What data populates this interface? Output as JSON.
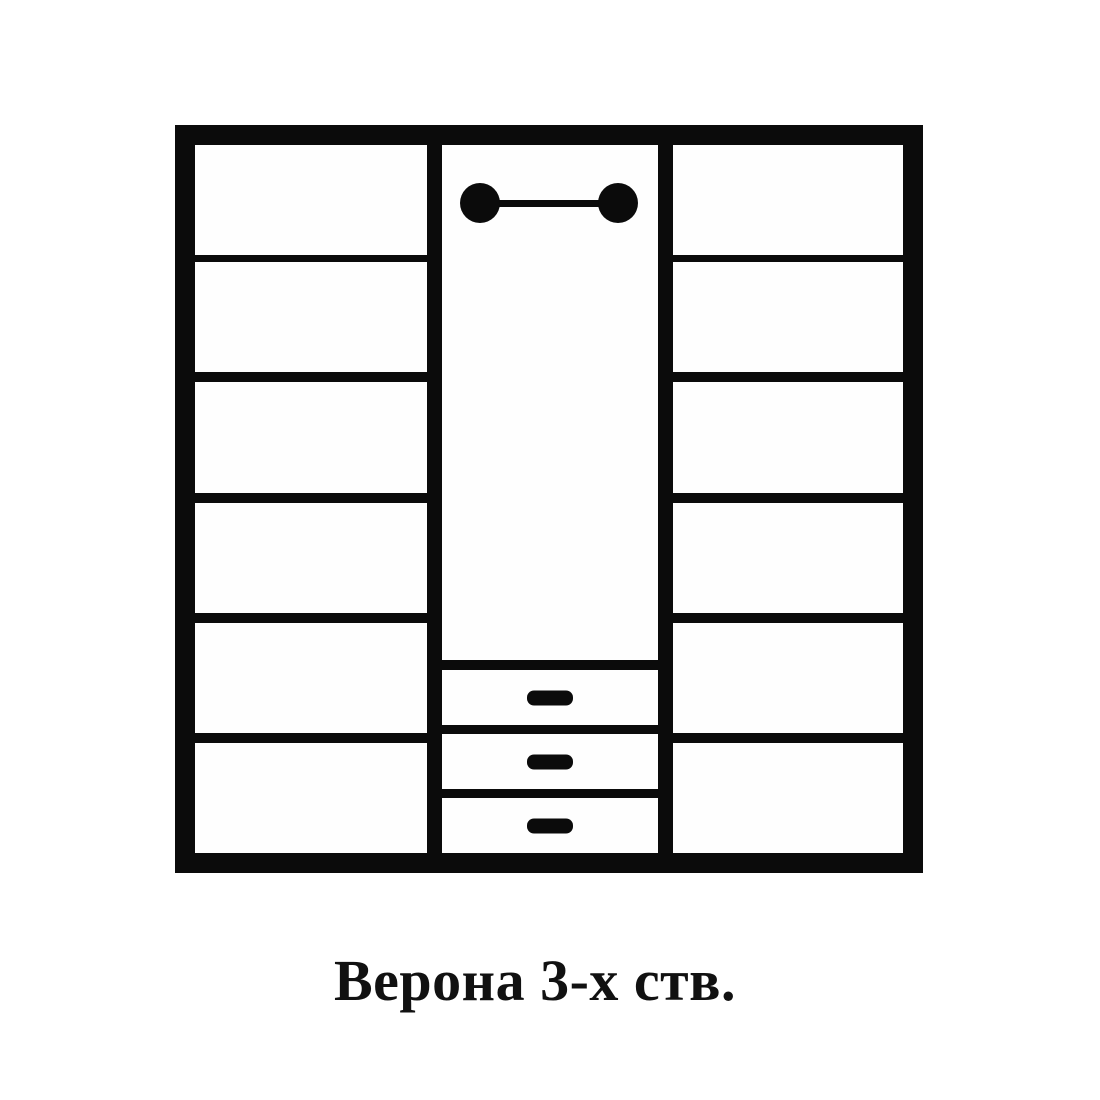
{
  "page": {
    "background_color": "#ffffff",
    "line_color": "#0b0b0b"
  },
  "diagram": {
    "type": "furniture-schematic",
    "caption": "Верона 3-х ств.",
    "wardrobe": {
      "left_section": {
        "content": "shelves",
        "shelf_compartments": 6
      },
      "middle_section": {
        "content": "hanging area with clothes rail and drawers",
        "clothes_rail": true,
        "drawer_count": 3
      },
      "right_section": {
        "content": "shelves",
        "shelf_compartments": 6
      }
    },
    "icons": {
      "clothes_rail": "clothes-rail-icon",
      "drawer_handle": "drawer-handle-icon"
    }
  }
}
